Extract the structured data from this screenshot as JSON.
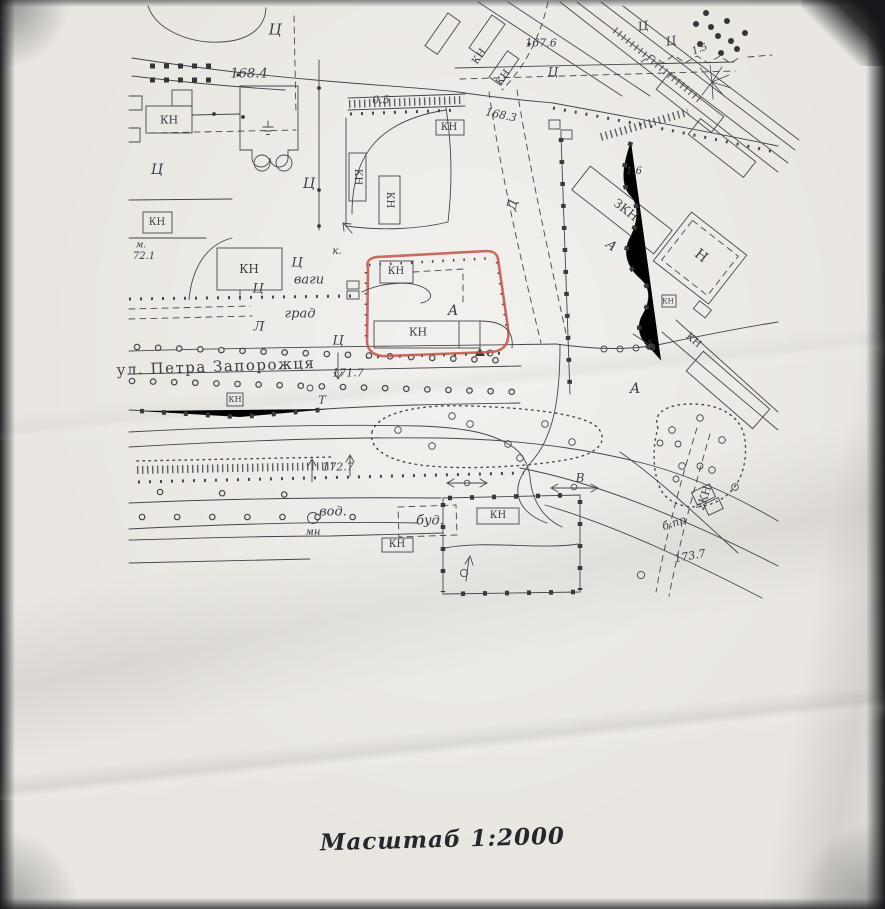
{
  "page": {
    "caption": "Масштаб 1:2000"
  },
  "map": {
    "street_name": "ул. Петра Запорожця",
    "ink_color": "#45454b",
    "paper_color": "#e9e6e1",
    "highlight_color": "#c2584a",
    "labels": [
      {
        "t": "Ц",
        "x": 275,
        "y": 30,
        "fs": 15,
        "i": 1
      },
      {
        "t": "Ц",
        "x": 157,
        "y": 170,
        "fs": 14,
        "i": 1
      },
      {
        "t": "Ц",
        "x": 309,
        "y": 184,
        "fs": 14,
        "i": 1
      },
      {
        "t": "Ц",
        "x": 297,
        "y": 263,
        "fs": 13,
        "i": 1
      },
      {
        "t": "Ц",
        "x": 258,
        "y": 289,
        "fs": 13,
        "i": 1
      },
      {
        "t": "Ц",
        "x": 338,
        "y": 341,
        "fs": 13,
        "i": 1
      },
      {
        "t": "Ц",
        "x": 643,
        "y": 26,
        "r": -10,
        "fs": 12,
        "i": 1
      },
      {
        "t": "Ц",
        "x": 671,
        "y": 41,
        "r": -10,
        "fs": 12,
        "i": 1
      },
      {
        "t": "Ц",
        "x": 553,
        "y": 72,
        "fs": 12,
        "i": 1
      },
      {
        "t": "А",
        "x": 453,
        "y": 311,
        "fs": 14,
        "i": 1
      },
      {
        "t": "А",
        "x": 611,
        "y": 246,
        "r": 38,
        "fs": 13,
        "i": 1
      },
      {
        "t": "А",
        "x": 635,
        "y": 389,
        "fs": 14,
        "i": 1
      },
      {
        "t": "Л",
        "x": 259,
        "y": 327,
        "fs": 13,
        "i": 1
      },
      {
        "t": "Д",
        "x": 513,
        "y": 205,
        "r": -75,
        "fs": 13,
        "i": 1
      },
      {
        "t": "Н",
        "x": 701,
        "y": 256,
        "r": 38,
        "fs": 14
      },
      {
        "t": "ЗКН",
        "x": 626,
        "y": 210,
        "r": 38,
        "fs": 12
      },
      {
        "t": "2КН",
        "x": 704,
        "y": 498,
        "r": -72,
        "fs": 11
      },
      {
        "t": "КН",
        "x": 169,
        "y": 120,
        "fs": 11
      },
      {
        "t": "КН",
        "x": 157,
        "y": 223,
        "fs": 10
      },
      {
        "t": "КН",
        "x": 249,
        "y": 269,
        "fs": 12
      },
      {
        "t": "КН",
        "x": 449,
        "y": 128,
        "fs": 10
      },
      {
        "t": "КН",
        "x": 396,
        "y": 272,
        "fs": 10
      },
      {
        "t": "КН",
        "x": 418,
        "y": 332,
        "fs": 11
      },
      {
        "t": "КН",
        "x": 235,
        "y": 400,
        "fs": 8
      },
      {
        "t": "КН",
        "x": 397,
        "y": 545,
        "fs": 10
      },
      {
        "t": "КН",
        "x": 498,
        "y": 516,
        "fs": 10
      },
      {
        "t": "КН",
        "x": 357,
        "y": 177,
        "r": 90,
        "fs": 10
      },
      {
        "t": "КН",
        "x": 389,
        "y": 200,
        "r": 90,
        "fs": 10
      },
      {
        "t": "КН",
        "x": 480,
        "y": 57,
        "r": -55,
        "fs": 10
      },
      {
        "t": "КН",
        "x": 504,
        "y": 78,
        "r": -55,
        "fs": 10
      },
      {
        "t": "КН",
        "x": 693,
        "y": 341,
        "r": 41,
        "fs": 10
      },
      {
        "t": "КН",
        "x": 668,
        "y": 302,
        "fs": 7
      },
      {
        "t": "168.4",
        "x": 249,
        "y": 74,
        "fs": 13,
        "i": 1
      },
      {
        "t": "167.6",
        "x": 541,
        "y": 43,
        "fs": 11,
        "i": 1
      },
      {
        "t": "168.3",
        "x": 501,
        "y": 115,
        "r": 12,
        "fs": 11,
        "i": 1
      },
      {
        "t": "0.5",
        "x": 381,
        "y": 100,
        "fs": 11,
        "i": 1
      },
      {
        "t": "1.5",
        "x": 700,
        "y": 50,
        "r": -20,
        "fs": 10,
        "i": 1
      },
      {
        "t": "1.6",
        "x": 634,
        "y": 172,
        "fs": 10,
        "i": 1
      },
      {
        "t": "м.",
        "x": 141,
        "y": 246,
        "fs": 9,
        "i": 1
      },
      {
        "t": "72.1",
        "x": 144,
        "y": 257,
        "fs": 10,
        "i": 1
      },
      {
        "t": "171.7",
        "x": 348,
        "y": 373,
        "fs": 11,
        "i": 1
      },
      {
        "t": "172.7",
        "x": 338,
        "y": 467,
        "fs": 11,
        "i": 1
      },
      {
        "t": "173.7",
        "x": 690,
        "y": 556,
        "r": -10,
        "fs": 11,
        "i": 1
      },
      {
        "t": "ваги",
        "x": 309,
        "y": 280,
        "fs": 13,
        "i": 1
      },
      {
        "t": "град",
        "x": 300,
        "y": 314,
        "fs": 13,
        "i": 1
      },
      {
        "t": "к.",
        "x": 337,
        "y": 252,
        "fs": 10,
        "i": 1
      },
      {
        "t": "вод.",
        "x": 333,
        "y": 512,
        "fs": 13,
        "i": 1
      },
      {
        "t": "мн",
        "x": 313,
        "y": 533,
        "fs": 10,
        "i": 1
      },
      {
        "t": "буд.",
        "x": 430,
        "y": 521,
        "fs": 13,
        "i": 1
      },
      {
        "t": "б.пр",
        "x": 674,
        "y": 523,
        "r": -18,
        "fs": 11,
        "i": 1
      },
      {
        "t": "Т",
        "x": 322,
        "y": 400,
        "fs": 11,
        "i": 1
      },
      {
        "t": "В",
        "x": 580,
        "y": 478,
        "fs": 12,
        "i": 1
      },
      {
        "t": "ул. Петра Запорожця",
        "x": 216,
        "y": 367,
        "r": -2,
        "fs": 15,
        "ls": 1.5
      }
    ]
  }
}
